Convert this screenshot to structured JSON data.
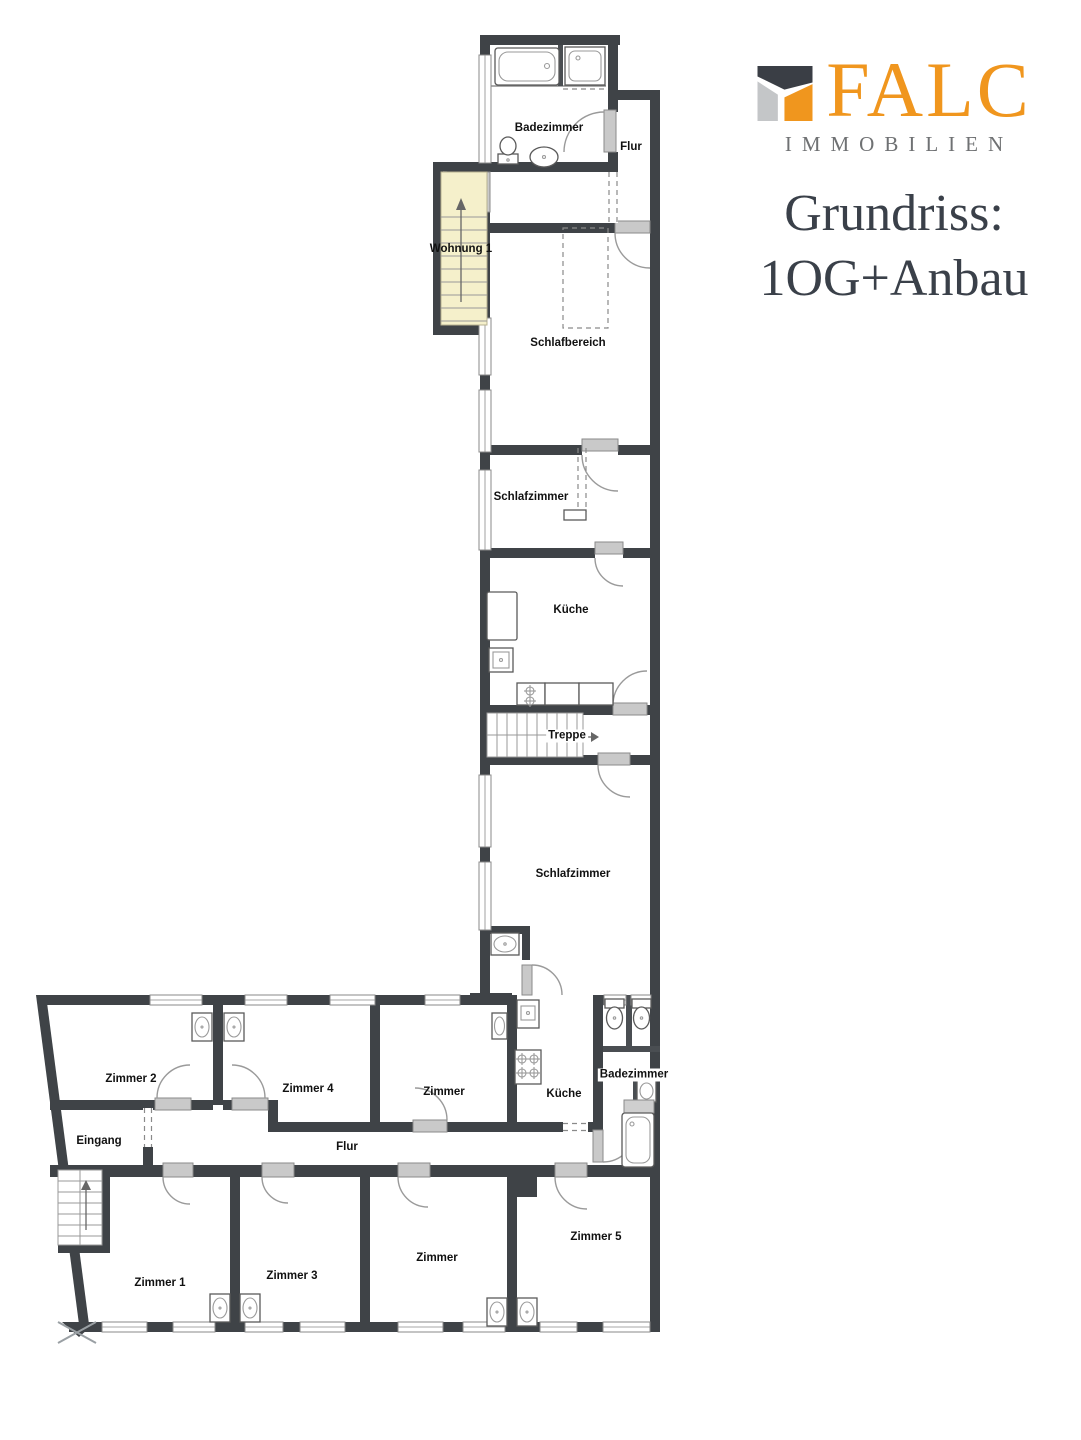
{
  "branding": {
    "logo_text": "FALC",
    "logo_subtext": "IMMOBILIEN",
    "title_line1": "Grundriss:",
    "title_line2": "1OG+Anbau",
    "colors": {
      "logo_orange": "#F0961E",
      "logo_dark": "#3A3E45",
      "logo_light_gray": "#C4C6C8",
      "subtext_gray": "#6F7173",
      "title_color": "#3A4049"
    }
  },
  "floorplan": {
    "wall_color": "#3F4347",
    "stair_highlight_color": "#F5F0CB",
    "labels": [
      {
        "id": "badezimmer-og",
        "text": "Badezimmer"
      },
      {
        "id": "flur-og",
        "text": "Flur"
      },
      {
        "id": "wohnung-1",
        "text": "Wohnung 1"
      },
      {
        "id": "schlafbereich",
        "text": "Schlafbereich"
      },
      {
        "id": "schlafzimmer-vorn",
        "text": "Schlafzimmer"
      },
      {
        "id": "kueche-og",
        "text": "Küche"
      },
      {
        "id": "treppe",
        "text": "Treppe"
      },
      {
        "id": "schlafzimmer-hinten",
        "text": "Schlafzimmer"
      },
      {
        "id": "zimmer-2",
        "text": "Zimmer 2"
      },
      {
        "id": "zimmer-4",
        "text": "Zimmer 4"
      },
      {
        "id": "zimmer-mitte-oben",
        "text": "Zimmer"
      },
      {
        "id": "kueche-anbau",
        "text": "Küche"
      },
      {
        "id": "badezimmer-anbau",
        "text": "Badezimmer"
      },
      {
        "id": "eingang",
        "text": "Eingang"
      },
      {
        "id": "flur-anbau",
        "text": "Flur"
      },
      {
        "id": "zimmer-1",
        "text": "Zimmer 1"
      },
      {
        "id": "zimmer-3",
        "text": "Zimmer 3"
      },
      {
        "id": "zimmer-mitte-unten",
        "text": "Zimmer"
      },
      {
        "id": "zimmer-5",
        "text": "Zimmer 5"
      }
    ]
  }
}
